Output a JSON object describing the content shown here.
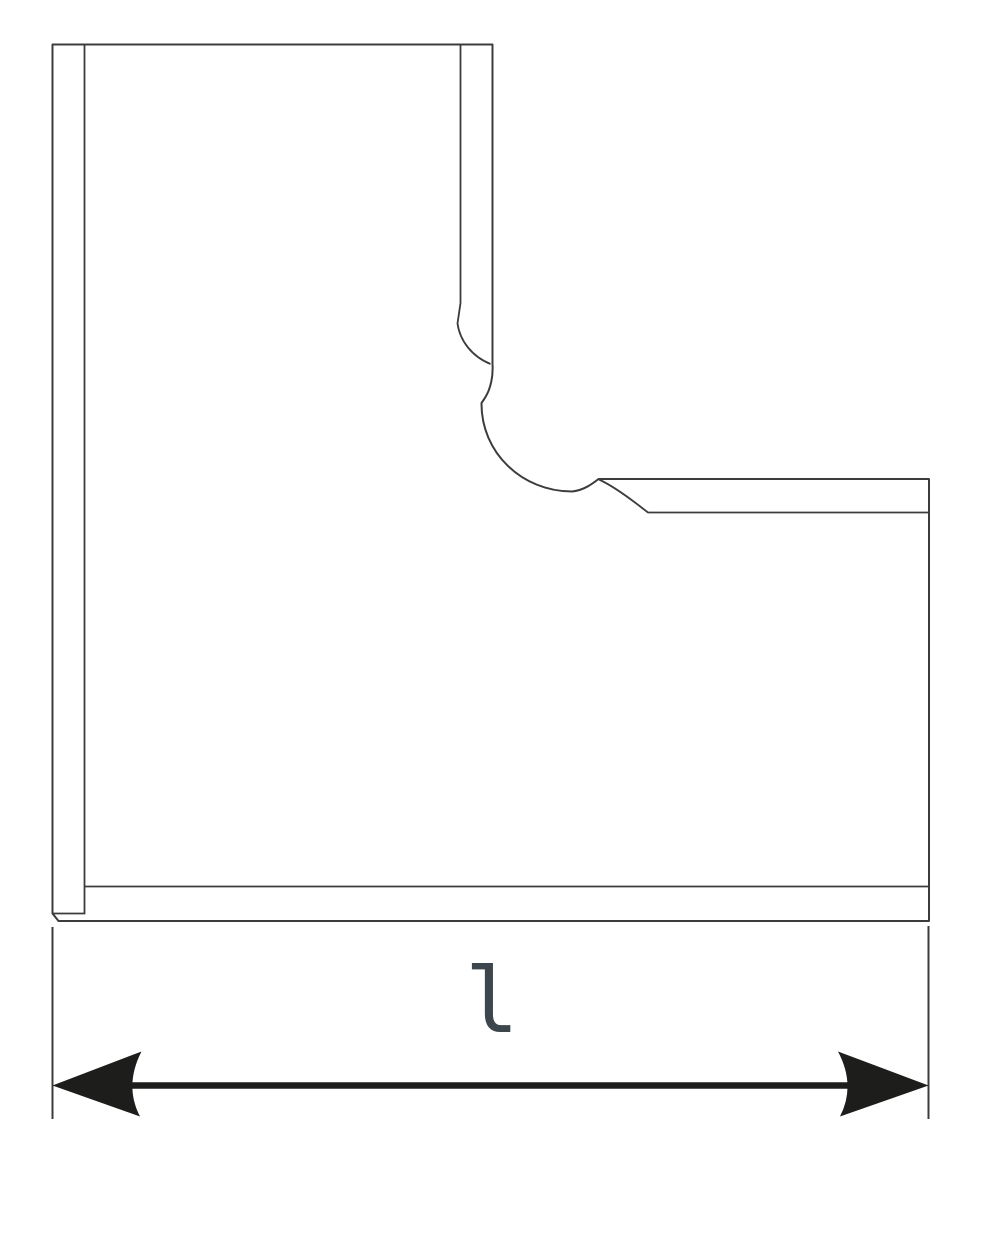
{
  "drawing": {
    "kind": "technical line drawing",
    "subject": "L-shaped corner profile with ogee moulding curve at the inner corner",
    "background": "#ffffff"
  },
  "dimension": {
    "label": "l",
    "arrow_ends": "both",
    "measures": "overall length across the bottom of the profile"
  },
  "colors": {
    "outline": "#3c3c3b",
    "inner_line": "#3c3c3b",
    "extension_line": "#3c3c3b",
    "arrow": "#1d1d1b",
    "label": "#3c464c",
    "fill": "#ffffff",
    "background": "#ffffff"
  }
}
